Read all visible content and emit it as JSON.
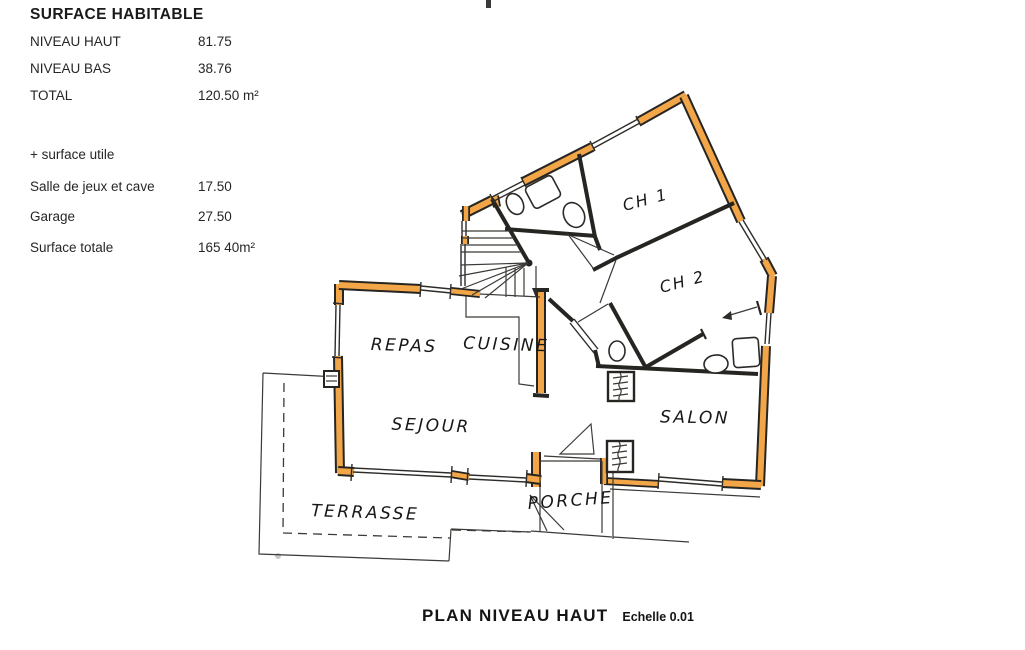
{
  "surface_table": {
    "title": "SURFACE HABITABLE",
    "rows": [
      {
        "label": "NIVEAU HAUT",
        "value": "81.75"
      },
      {
        "label": "NIVEAU BAS",
        "value": "38.76"
      },
      {
        "label": "TOTAL",
        "value": "120.50 m²"
      }
    ],
    "note": "+ surface utile",
    "extra_rows": [
      {
        "label": "Salle de jeux et cave",
        "value": "17.50"
      },
      {
        "label": "Garage",
        "value": "27.50"
      },
      {
        "label": "Surface totale",
        "value": "165 40m²"
      }
    ]
  },
  "plan": {
    "rooms": [
      {
        "id": "ch1",
        "label": "CH 1"
      },
      {
        "id": "ch2",
        "label": "CH 2"
      },
      {
        "id": "repas",
        "label": "REPAS"
      },
      {
        "id": "cuisine",
        "label": "CUISINE"
      },
      {
        "id": "sejour",
        "label": "SEJOUR"
      },
      {
        "id": "salon",
        "label": "SALON"
      },
      {
        "id": "terrasse",
        "label": "TERRASSE"
      },
      {
        "id": "porche",
        "label": "PORCHE"
      }
    ]
  },
  "caption": {
    "title": "PLAN NIVEAU HAUT",
    "scale": "Echelle 0.01"
  },
  "colors": {
    "wall_fill": "#f2a648",
    "ink": "#262522",
    "paper": "#ffffff"
  }
}
